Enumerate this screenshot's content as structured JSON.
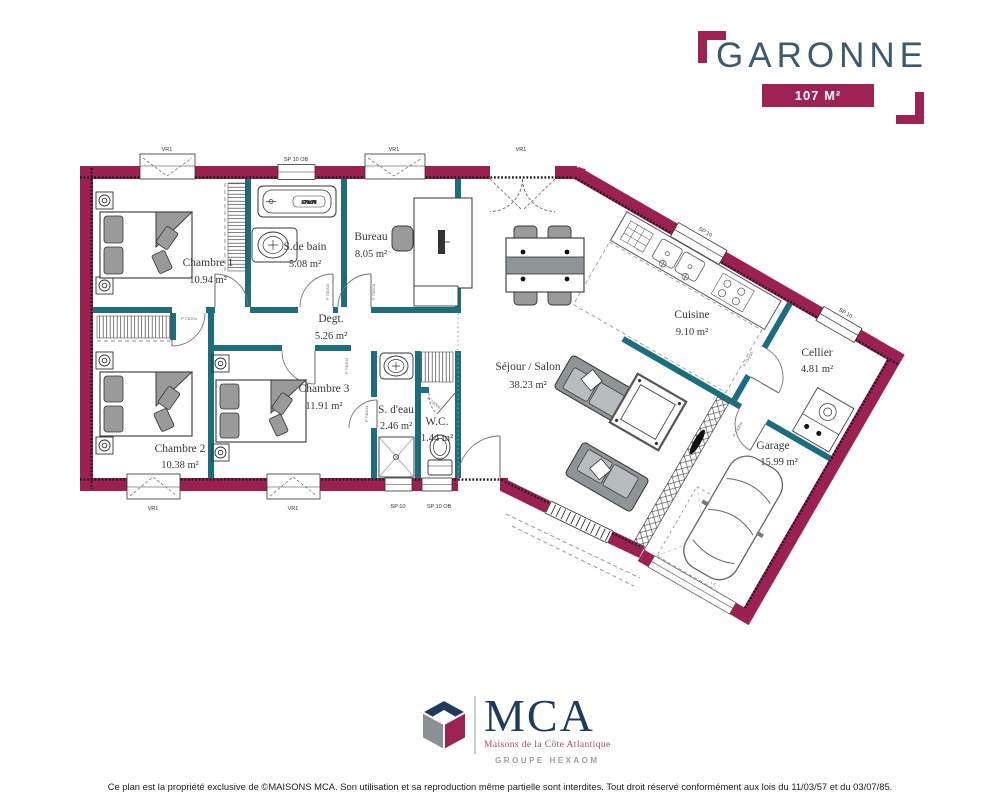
{
  "header": {
    "title": "GARONNE",
    "area_badge": "107 M²"
  },
  "plan": {
    "rooms": [
      {
        "id": "chambre-1",
        "name": "Chambre 1",
        "area": "10.94 m²"
      },
      {
        "id": "salle-de-bain",
        "name": "S.de bain",
        "area": "5.08 m²"
      },
      {
        "id": "bureau",
        "name": "Bureau",
        "area": "8.05 m²"
      },
      {
        "id": "degagement",
        "name": "Degt.",
        "area": "5.26 m²"
      },
      {
        "id": "chambre-2",
        "name": "Chambre 2",
        "area": "10.38 m²"
      },
      {
        "id": "chambre-3",
        "name": "Chambre 3",
        "area": "11.91 m²"
      },
      {
        "id": "salle-deau",
        "name": "S. d'eau",
        "area": "2.46 m²"
      },
      {
        "id": "wc",
        "name": "W.C.",
        "area": "1.44 m²"
      },
      {
        "id": "sejour-salon",
        "name": "Séjour / Salon",
        "area": "38.23 m²"
      },
      {
        "id": "cuisine",
        "name": "Cuisine",
        "area": "9.10 m²"
      },
      {
        "id": "cellier",
        "name": "Cellier",
        "area": "4.81 m²"
      },
      {
        "id": "garage",
        "name": "Garage",
        "area": "15.99 m²"
      }
    ],
    "window_labels": {
      "vr": "VR1",
      "sp": "SP 10",
      "sp_ob": "SP 10 OB"
    },
    "door_label": "P 73/204",
    "bathtub_label": "170x75"
  },
  "logo": {
    "name": "MCA",
    "subtitle": "Maisons de la Côte Atlantique",
    "group": "GROUPE HEXAOM"
  },
  "footer": {
    "copyright": "Ce plan est la propriété exclusive de ©MAISONS MCA. Son utilisation et sa reproduction même partielle sont interdites. Tout droit réservé conformément aux lois du 11/03/57 et du 03/07/85."
  },
  "colors": {
    "wall": "#9C2152",
    "partition": "#1A6E7E",
    "accent": "#9E2253",
    "title": "#3C5A6D",
    "logo_navy": "#1F3A5C",
    "logo_gray": "#9AA0A6"
  }
}
